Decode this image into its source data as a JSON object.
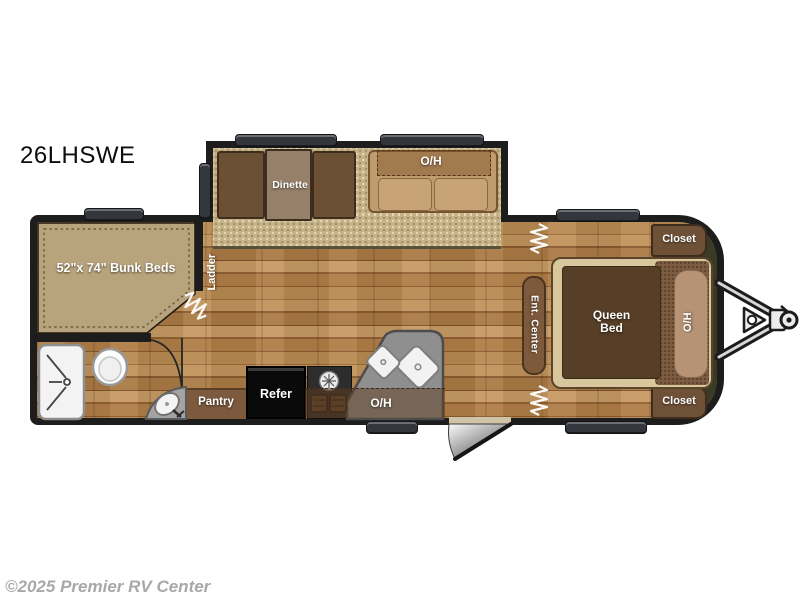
{
  "title": {
    "model": "26LHSWE"
  },
  "watermark": "©2025 Premier RV Center",
  "labels": {
    "dinette": "Dinette",
    "sofa_overhead": "O/H",
    "bunk_beds": "52\"x 74\" Bunk Beds",
    "ladder": "Ladder",
    "closet_top": "Closet",
    "closet_bottom": "Closet",
    "queen_bed": "Queen Bed",
    "bed_overhead": "O/H",
    "ent_center": "Ent. Center",
    "pantry": "Pantry",
    "refrigerator": "Refer",
    "kitchen_overhead": "O/H"
  },
  "fixtures": [
    "shower",
    "toilet",
    "corner-sink",
    "kitchen-counter",
    "double-sink",
    "range-burners",
    "bunk-mattress",
    "privacy-curtain",
    "bathroom-door-swing",
    "entry-door-swing",
    "window",
    "hitch",
    "front-cap"
  ],
  "colors": {
    "wall": "#1d1d1d",
    "wood_floor": "#b08049",
    "carpet": "#c6b288",
    "front_cap": "#3a3b25",
    "cabinet_brown": "#6f5138",
    "overhead_tint": "rgba(96,62,32,0.5)",
    "label_text": "#ffffff",
    "model_text": "#0d0d0d",
    "watermark_text": "#a8a8a8"
  }
}
